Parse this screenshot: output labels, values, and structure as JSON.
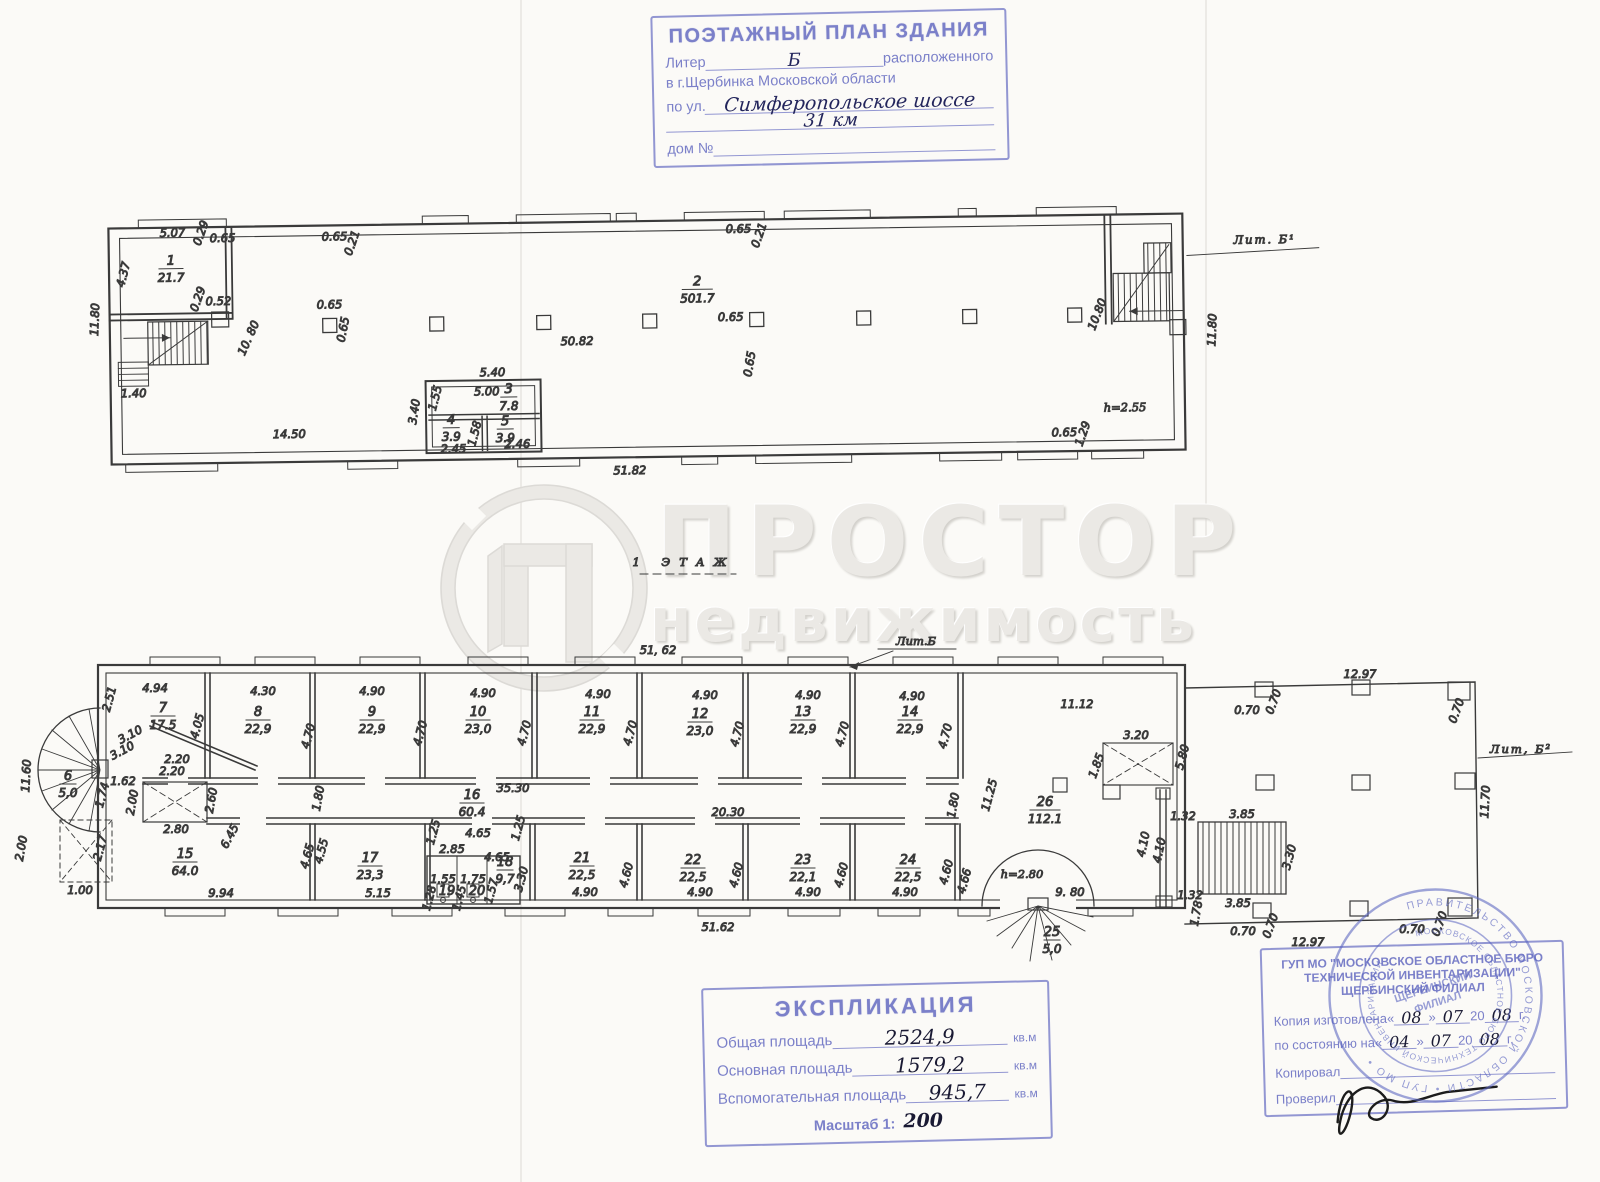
{
  "colors": {
    "stamp_ink": "#7b80c9",
    "hand_ink": "#23255c",
    "pencil": "#3c3c3c",
    "paper": "#fbfaf7",
    "watermark": "#ebe9e5"
  },
  "watermark": {
    "word1": "ПРОСТОР",
    "word2": "недвижимость"
  },
  "page": {
    "floor_note": "1 ЭТАЖ"
  },
  "header_stamp": {
    "title": "ПОЭТАЖНЫЙ ПЛАН ЗДАНИЯ",
    "liter_label": "Литер",
    "liter_value": "Б",
    "located": "расположенного",
    "city_line": "в г.Щербинка Московской области",
    "street_label": "по ул.",
    "street_value": "Симферопольское шоссе",
    "street_value2": "31 км",
    "house_label": "дом №"
  },
  "upper_plan": {
    "rooms": [
      {
        "n": "1",
        "a": "21.7",
        "x": 172,
        "y": 258
      },
      {
        "n": "2",
        "a": "501.7",
        "x": 698,
        "y": 286
      },
      {
        "n": "3",
        "a": "7.8",
        "x": 508,
        "y": 391,
        "small": true
      },
      {
        "n": "4",
        "a": "3.9",
        "x": 450,
        "y": 421,
        "small": true
      },
      {
        "n": "5",
        "a": "3.9",
        "x": 504,
        "y": 423,
        "small": true
      }
    ],
    "dims": [
      {
        "t": "5.07",
        "x": 174,
        "y": 230
      },
      {
        "t": "0.29",
        "x": 206,
        "y": 228,
        "r": -70,
        "s": 9
      },
      {
        "t": "0.65",
        "x": 224,
        "y": 236,
        "s": 10
      },
      {
        "t": "0.65",
        "x": 336,
        "y": 236,
        "s": 10
      },
      {
        "t": "0.21",
        "x": 357,
        "y": 240,
        "r": -70,
        "s": 9
      },
      {
        "t": "0.65",
        "x": 740,
        "y": 234,
        "s": 10
      },
      {
        "t": "0.21",
        "x": 764,
        "y": 238,
        "r": -70,
        "s": 9
      },
      {
        "t": "4.37",
        "x": 128,
        "y": 268,
        "r": -75
      },
      {
        "t": "11.80",
        "x": 99,
        "y": 312,
        "r": -87
      },
      {
        "t": "0.52",
        "x": 219,
        "y": 299,
        "s": 10
      },
      {
        "t": "0.29",
        "x": 202,
        "y": 294,
        "r": -70,
        "s": 9
      },
      {
        "t": "10. 80",
        "x": 252,
        "y": 334,
        "r": -65
      },
      {
        "t": "0.65",
        "x": 330,
        "y": 304,
        "s": 10
      },
      {
        "t": "0.65",
        "x": 347,
        "y": 326,
        "r": -78,
        "s": 9
      },
      {
        "t": "0.65",
        "x": 731,
        "y": 322,
        "s": 10
      },
      {
        "t": "0.65",
        "x": 753,
        "y": 366,
        "r": -80,
        "s": 9
      },
      {
        "t": "50.82",
        "x": 577,
        "y": 344,
        "s": 13
      },
      {
        "t": "1.40",
        "x": 133,
        "y": 390,
        "s": 10
      },
      {
        "t": "14.50",
        "x": 288,
        "y": 433,
        "s": 14
      },
      {
        "t": "5.40",
        "x": 492,
        "y": 374,
        "s": 10
      },
      {
        "t": "5.00",
        "x": 486,
        "y": 393,
        "s": 10
      },
      {
        "t": "1.55",
        "x": 438,
        "y": 396,
        "r": -75,
        "s": 9
      },
      {
        "t": "3.40",
        "x": 417,
        "y": 409,
        "r": -80,
        "s": 9
      },
      {
        "t": "2.45",
        "x": 452,
        "y": 450,
        "s": 9
      },
      {
        "t": "1.58",
        "x": 477,
        "y": 432,
        "r": -75,
        "s": 9
      },
      {
        "t": "2.46",
        "x": 516,
        "y": 446,
        "s": 9
      },
      {
        "t": "51.82",
        "x": 628,
        "y": 474,
        "s": 13
      },
      {
        "t": "10.80",
        "x": 1101,
        "y": 322,
        "r": -68
      },
      {
        "t": "11.80",
        "x": 1216,
        "y": 338,
        "r": -87
      },
      {
        "t": "0.65",
        "x": 1063,
        "y": 442,
        "s": 9
      },
      {
        "t": "1.29",
        "x": 1085,
        "y": 441,
        "r": -70,
        "s": 9
      },
      {
        "t": "h=2.55",
        "x": 1124,
        "y": 418,
        "s": 17,
        "c": "hand",
        "n": "height-note-upper"
      },
      {
        "t": "Лит. Б¹",
        "x": 1266,
        "y": 252,
        "s": 17,
        "c": "hand",
        "n": "liter-label-upper",
        "ls": 2
      }
    ]
  },
  "lower_plan": {
    "rooms": [
      {
        "n": "7",
        "a": "17.5",
        "x": 163,
        "y": 712
      },
      {
        "n": "8",
        "a": "22,9",
        "x": 258,
        "y": 716
      },
      {
        "n": "9",
        "a": "22,9",
        "x": 372,
        "y": 716
      },
      {
        "n": "10",
        "a": "23,0",
        "x": 478,
        "y": 716
      },
      {
        "n": "11",
        "a": "22,9",
        "x": 592,
        "y": 716
      },
      {
        "n": "12",
        "a": "23,0",
        "x": 700,
        "y": 718
      },
      {
        "n": "13",
        "a": "22,9",
        "x": 803,
        "y": 716
      },
      {
        "n": "14",
        "a": "22,9",
        "x": 910,
        "y": 716
      },
      {
        "n": "15",
        "a": "64.0",
        "x": 185,
        "y": 858
      },
      {
        "n": "16",
        "a": "60.4",
        "x": 472,
        "y": 799
      },
      {
        "n": "17",
        "a": "23,3",
        "x": 370,
        "y": 862
      },
      {
        "n": "18",
        "a": "9,7",
        "x": 505,
        "y": 866,
        "small": true
      },
      {
        "n": "19",
        "x": 447,
        "y": 895,
        "small": true
      },
      {
        "n": "20",
        "x": 477,
        "y": 895,
        "small": true
      },
      {
        "n": "21",
        "a": "22,5",
        "x": 582,
        "y": 862
      },
      {
        "n": "22",
        "a": "22,5",
        "x": 693,
        "y": 864
      },
      {
        "n": "23",
        "a": "22,1",
        "x": 803,
        "y": 864
      },
      {
        "n": "24",
        "a": "22,5",
        "x": 908,
        "y": 864
      },
      {
        "n": "25",
        "a": "5,0",
        "x": 1052,
        "y": 936,
        "small": true
      },
      {
        "n": "26",
        "a": "112.1",
        "x": 1045,
        "y": 806
      },
      {
        "n": "6",
        "a": "5,0",
        "x": 68,
        "y": 780,
        "small": true
      }
    ],
    "dims": [
      {
        "t": "51, 62",
        "x": 658,
        "y": 654,
        "s": 13
      },
      {
        "t": "4.94",
        "x": 155,
        "y": 692
      },
      {
        "t": "4.30",
        "x": 263,
        "y": 695
      },
      {
        "t": "4.90",
        "x": 372,
        "y": 695
      },
      {
        "t": "4.90",
        "x": 483,
        "y": 697
      },
      {
        "t": "4.90",
        "x": 598,
        "y": 698
      },
      {
        "t": "4.90",
        "x": 705,
        "y": 699
      },
      {
        "t": "4.90",
        "x": 808,
        "y": 699
      },
      {
        "t": "4.90",
        "x": 912,
        "y": 700
      },
      {
        "t": "11.12",
        "x": 1077,
        "y": 708,
        "s": 13
      },
      {
        "t": "2.51",
        "x": 113,
        "y": 700,
        "r": -75,
        "s": 9
      },
      {
        "t": "4.05",
        "x": 201,
        "y": 727,
        "r": -75
      },
      {
        "t": "4.70",
        "x": 312,
        "y": 737,
        "r": -75
      },
      {
        "t": "4.70",
        "x": 424,
        "y": 734,
        "r": -75
      },
      {
        "t": "4.70",
        "x": 528,
        "y": 734,
        "r": -75
      },
      {
        "t": "4.70",
        "x": 634,
        "y": 734,
        "r": -75
      },
      {
        "t": "4.70",
        "x": 741,
        "y": 735,
        "r": -75
      },
      {
        "t": "4.70",
        "x": 846,
        "y": 735,
        "r": -75
      },
      {
        "t": "4.70",
        "x": 949,
        "y": 737,
        "r": -75
      },
      {
        "t": "3.10",
        "x": 132,
        "y": 738,
        "r": -28,
        "s": 10
      },
      {
        "t": "3.10",
        "x": 124,
        "y": 754,
        "r": -28,
        "s": 10
      },
      {
        "t": "2.20",
        "x": 177,
        "y": 763,
        "s": 10
      },
      {
        "t": "2.20",
        "x": 172,
        "y": 775,
        "s": 10
      },
      {
        "t": "1.62",
        "x": 123,
        "y": 785,
        "s": 10
      },
      {
        "t": "2.00",
        "x": 136,
        "y": 803,
        "r": -80,
        "s": 10
      },
      {
        "t": "2.80",
        "x": 176,
        "y": 833,
        "s": 10
      },
      {
        "t": "2.60",
        "x": 215,
        "y": 801,
        "r": -80,
        "s": 10
      },
      {
        "t": "1.74",
        "x": 106,
        "y": 796,
        "r": -75,
        "s": 9
      },
      {
        "t": "2.17",
        "x": 104,
        "y": 849,
        "r": -75,
        "s": 9
      },
      {
        "t": "11.60",
        "x": 30,
        "y": 776,
        "r": -87
      },
      {
        "t": "2.00",
        "x": 25,
        "y": 849,
        "r": -80
      },
      {
        "t": "1.00",
        "x": 80,
        "y": 894,
        "s": 11
      },
      {
        "t": "6.45",
        "x": 233,
        "y": 838,
        "r": -62
      },
      {
        "t": "35.30",
        "x": 513,
        "y": 792,
        "s": 13
      },
      {
        "t": "20.30",
        "x": 728,
        "y": 816,
        "s": 12
      },
      {
        "t": "1.80",
        "x": 322,
        "y": 799,
        "r": -80,
        "s": 9
      },
      {
        "t": "1.80",
        "x": 957,
        "y": 806,
        "r": -80,
        "s": 9
      },
      {
        "t": "11.25",
        "x": 993,
        "y": 796,
        "r": -75
      },
      {
        "t": "3.20",
        "x": 1136,
        "y": 739
      },
      {
        "t": "1.85",
        "x": 1100,
        "y": 767,
        "r": -70,
        "s": 10
      },
      {
        "t": "5.80",
        "x": 1186,
        "y": 758,
        "r": -75
      },
      {
        "t": "9.94",
        "x": 221,
        "y": 897
      },
      {
        "t": "5.15",
        "x": 378,
        "y": 897
      },
      {
        "t": "4.65",
        "x": 311,
        "y": 857,
        "r": -75,
        "s": 9
      },
      {
        "t": "4.55",
        "x": 325,
        "y": 852,
        "r": -75,
        "s": 9
      },
      {
        "t": "4.65",
        "x": 478,
        "y": 837,
        "s": 10
      },
      {
        "t": "4.65",
        "x": 497,
        "y": 861,
        "s": 10
      },
      {
        "t": "1.25",
        "x": 437,
        "y": 833,
        "r": -75,
        "s": 9
      },
      {
        "t": "1.25",
        "x": 522,
        "y": 829,
        "r": -75,
        "s": 9
      },
      {
        "t": "2.85",
        "x": 452,
        "y": 853,
        "s": 9
      },
      {
        "t": "1.55",
        "x": 443,
        "y": 883,
        "s": 8
      },
      {
        "t": "1.75",
        "x": 473,
        "y": 883,
        "s": 8
      },
      {
        "t": "1.28",
        "x": 433,
        "y": 899,
        "r": -75,
        "s": 8
      },
      {
        "t": "1.45",
        "x": 463,
        "y": 899,
        "r": -75,
        "s": 8
      },
      {
        "t": "1.57",
        "x": 495,
        "y": 892,
        "r": -75,
        "s": 8
      },
      {
        "t": "3.30",
        "x": 525,
        "y": 880,
        "r": -75,
        "s": 9
      },
      {
        "t": "4.60",
        "x": 630,
        "y": 876,
        "r": -75
      },
      {
        "t": "4.60",
        "x": 740,
        "y": 876,
        "r": -75
      },
      {
        "t": "4.60",
        "x": 845,
        "y": 876,
        "r": -75
      },
      {
        "t": "4.60",
        "x": 950,
        "y": 873,
        "r": -75
      },
      {
        "t": "4.66",
        "x": 968,
        "y": 882,
        "r": -75,
        "s": 9
      },
      {
        "t": "4.90",
        "x": 585,
        "y": 896
      },
      {
        "t": "4.90",
        "x": 700,
        "y": 896
      },
      {
        "t": "4.90",
        "x": 808,
        "y": 896
      },
      {
        "t": "4.90",
        "x": 905,
        "y": 896
      },
      {
        "t": "9. 80",
        "x": 1070,
        "y": 896,
        "s": 13
      },
      {
        "t": "1.32",
        "x": 1183,
        "y": 820,
        "s": 9
      },
      {
        "t": "4.10",
        "x": 1163,
        "y": 851,
        "r": -78,
        "s": 10
      },
      {
        "t": "4.10",
        "x": 1147,
        "y": 845,
        "r": -78,
        "s": 9
      },
      {
        "t": "1.32",
        "x": 1190,
        "y": 899,
        "s": 9
      },
      {
        "t": "1.78",
        "x": 1200,
        "y": 914,
        "r": -80,
        "s": 9
      },
      {
        "t": "3.85",
        "x": 1242,
        "y": 818
      },
      {
        "t": "3.85",
        "x": 1238,
        "y": 907
      },
      {
        "t": "3.30",
        "x": 1293,
        "y": 858,
        "r": -75
      },
      {
        "t": "12.97",
        "x": 1360,
        "y": 678,
        "s": 12
      },
      {
        "t": "0.70",
        "x": 1247,
        "y": 714,
        "s": 9
      },
      {
        "t": "0.70",
        "x": 1277,
        "y": 703,
        "r": -70,
        "s": 9
      },
      {
        "t": "0.70",
        "x": 1460,
        "y": 712,
        "r": -70,
        "s": 9
      },
      {
        "t": "11.70",
        "x": 1489,
        "y": 802,
        "r": -87
      },
      {
        "t": "0.70",
        "x": 1243,
        "y": 935,
        "s": 9
      },
      {
        "t": "0.70",
        "x": 1274,
        "y": 927,
        "r": -70,
        "s": 9
      },
      {
        "t": "0.70",
        "x": 1412,
        "y": 933,
        "s": 9
      },
      {
        "t": "0.70",
        "x": 1443,
        "y": 925,
        "r": -70,
        "s": 9
      },
      {
        "t": "12.97",
        "x": 1308,
        "y": 946,
        "s": 12
      },
      {
        "t": "51.62",
        "x": 718,
        "y": 931,
        "s": 13
      },
      {
        "t": "h=2.80",
        "x": 1022,
        "y": 878,
        "s": 17,
        "c": "hand",
        "n": "height-note-lower"
      },
      {
        "t": "Лит.Б",
        "x": 916,
        "y": 645,
        "s": 16,
        "c": "hand",
        "n": "liter-label-lower-top"
      },
      {
        "t": "Лит, Б²",
        "x": 1521,
        "y": 753,
        "s": 17,
        "c": "hand",
        "n": "liter-label-lower-right",
        "ls": 2
      },
      {
        "t": "1 ЭТАЖ",
        "x": 684,
        "y": 566,
        "s": 24,
        "c": "hand",
        "n": "floor-note",
        "ls": 9
      }
    ]
  },
  "explication_stamp": {
    "title": "ЭКСПЛИКАЦИЯ",
    "rows": [
      {
        "label": "Общая площадь",
        "value": "2524,9",
        "unit": "кв.м"
      },
      {
        "label": "Основная площадь",
        "value": "1579,2",
        "unit": "кв.м"
      },
      {
        "label": "Вспомогательная площадь",
        "value": "945,7",
        "unit": "кв.м"
      }
    ],
    "scale_label": "Масштаб 1:",
    "scale_value": "200"
  },
  "bti_stamp": {
    "org_line1": "ГУП МО \"МОСКОВСКОЕ ОБЛАСТНОЕ БЮРО",
    "org_line2": "ТЕХНИЧЕСКОЙ ИНВЕНТАРИЗАЦИИ\"",
    "org_line3": "ЩЕРБИНСКИЙ ФИЛИАЛ",
    "row1_label": "Копия изготовлена",
    "row1_day": "08",
    "row1_month": "07",
    "row1_c": "20",
    "row1_year": "08",
    "row1_suffix": "г.",
    "row2_label": "по состоянию на",
    "row2_day": "04",
    "row2_month": "07",
    "row2_c": "20",
    "row2_year": "08",
    "row2_suffix": "г.",
    "row3_label": "Копировал",
    "row4_label": "Проверил",
    "q_open": "«",
    "q_close": "»"
  },
  "seal": {
    "outer": "ПРАВИТЕЛЬСТВО МОСКОВСКОЙ ОБЛАСТИ  •  ГУП МО  •",
    "inner": "МОСКОВСКОЕ ОБЛАСТНОЕ БЮРО ТЕХНИЧЕСКОЙ ИНВЕНТАРИЗАЦИИ",
    "center1": "ЩЕРБИНСКИЙ",
    "center2": "ФИЛИАЛ"
  }
}
